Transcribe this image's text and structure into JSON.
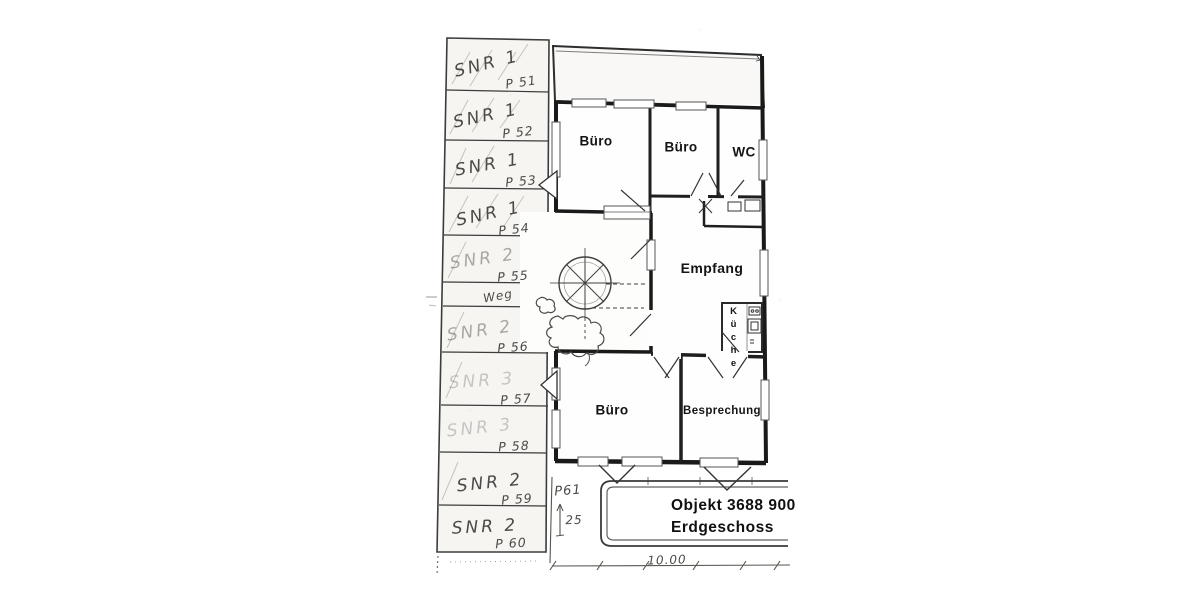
{
  "title": {
    "object": "Objekt 3688 900",
    "floor": "Erdgeschoss"
  },
  "rooms": {
    "buero_top_left": "Büro",
    "buero_top_mid": "Büro",
    "wc": "WC",
    "empfang": "Empfang",
    "kueche": "Küche",
    "buero_bottom": "Büro",
    "besprechung": "Besprechung"
  },
  "parking": {
    "path_label": "Weg",
    "stalls": [
      {
        "snr": "SNR 1",
        "p": "P 51"
      },
      {
        "snr": "SNR 1",
        "p": "P 52"
      },
      {
        "snr": "SNR 1",
        "p": "P 53"
      },
      {
        "snr": "SNR 1",
        "p": "P 54"
      },
      {
        "snr": "SNR 2",
        "p": "P 55"
      },
      {
        "snr": "SNR 2",
        "p": "P 56"
      },
      {
        "snr": "SNR 3",
        "p": "P 57"
      },
      {
        "snr": "SNR 3",
        "p": "P 58"
      },
      {
        "snr": "SNR 2",
        "p": "P 59"
      },
      {
        "snr": "SNR 2",
        "p": "P 60"
      }
    ]
  },
  "dimensions": {
    "p61": "P61",
    "offset": "25",
    "width": "10.00"
  },
  "colors": {
    "paper": "#fdfdfb",
    "ink": "#3a3a3a",
    "wall": "#1a1a1a",
    "handwriting": "#4a4a48",
    "stall_fill": "#f6f5f2"
  }
}
